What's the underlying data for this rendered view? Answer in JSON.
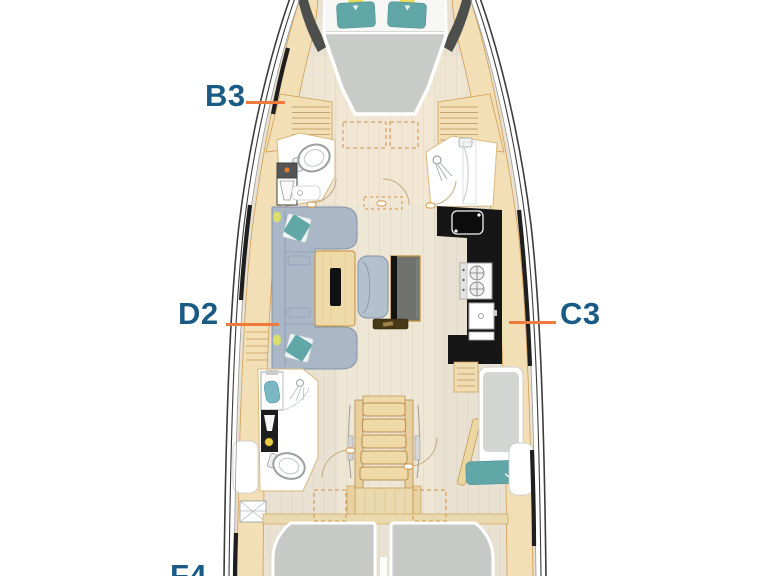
{
  "floor_plan": {
    "type": "yacht interior layout plan",
    "labels": {
      "b3": {
        "text": "B3"
      },
      "d2": {
        "text": "D2"
      },
      "c3": {
        "text": "C3"
      },
      "f4": {
        "text": "F4"
      }
    },
    "colors": {
      "label_text": "#1a5b86",
      "leader_line": "#ec7b3c",
      "hull_outline": "#3c3c3c",
      "wood_trim": "#f3dfb5",
      "wood_trim_outline": "#cf9e55",
      "floor": "#e9e1d2",
      "mattress_gray": "#c8cbc8",
      "sofa_gray_blue": "#a9b7c7",
      "cushion_teal": "#61a7a7",
      "galley_counter_black": "#161616",
      "accent_yellow": "#e6d84e",
      "room_white": "#ffffff"
    }
  }
}
